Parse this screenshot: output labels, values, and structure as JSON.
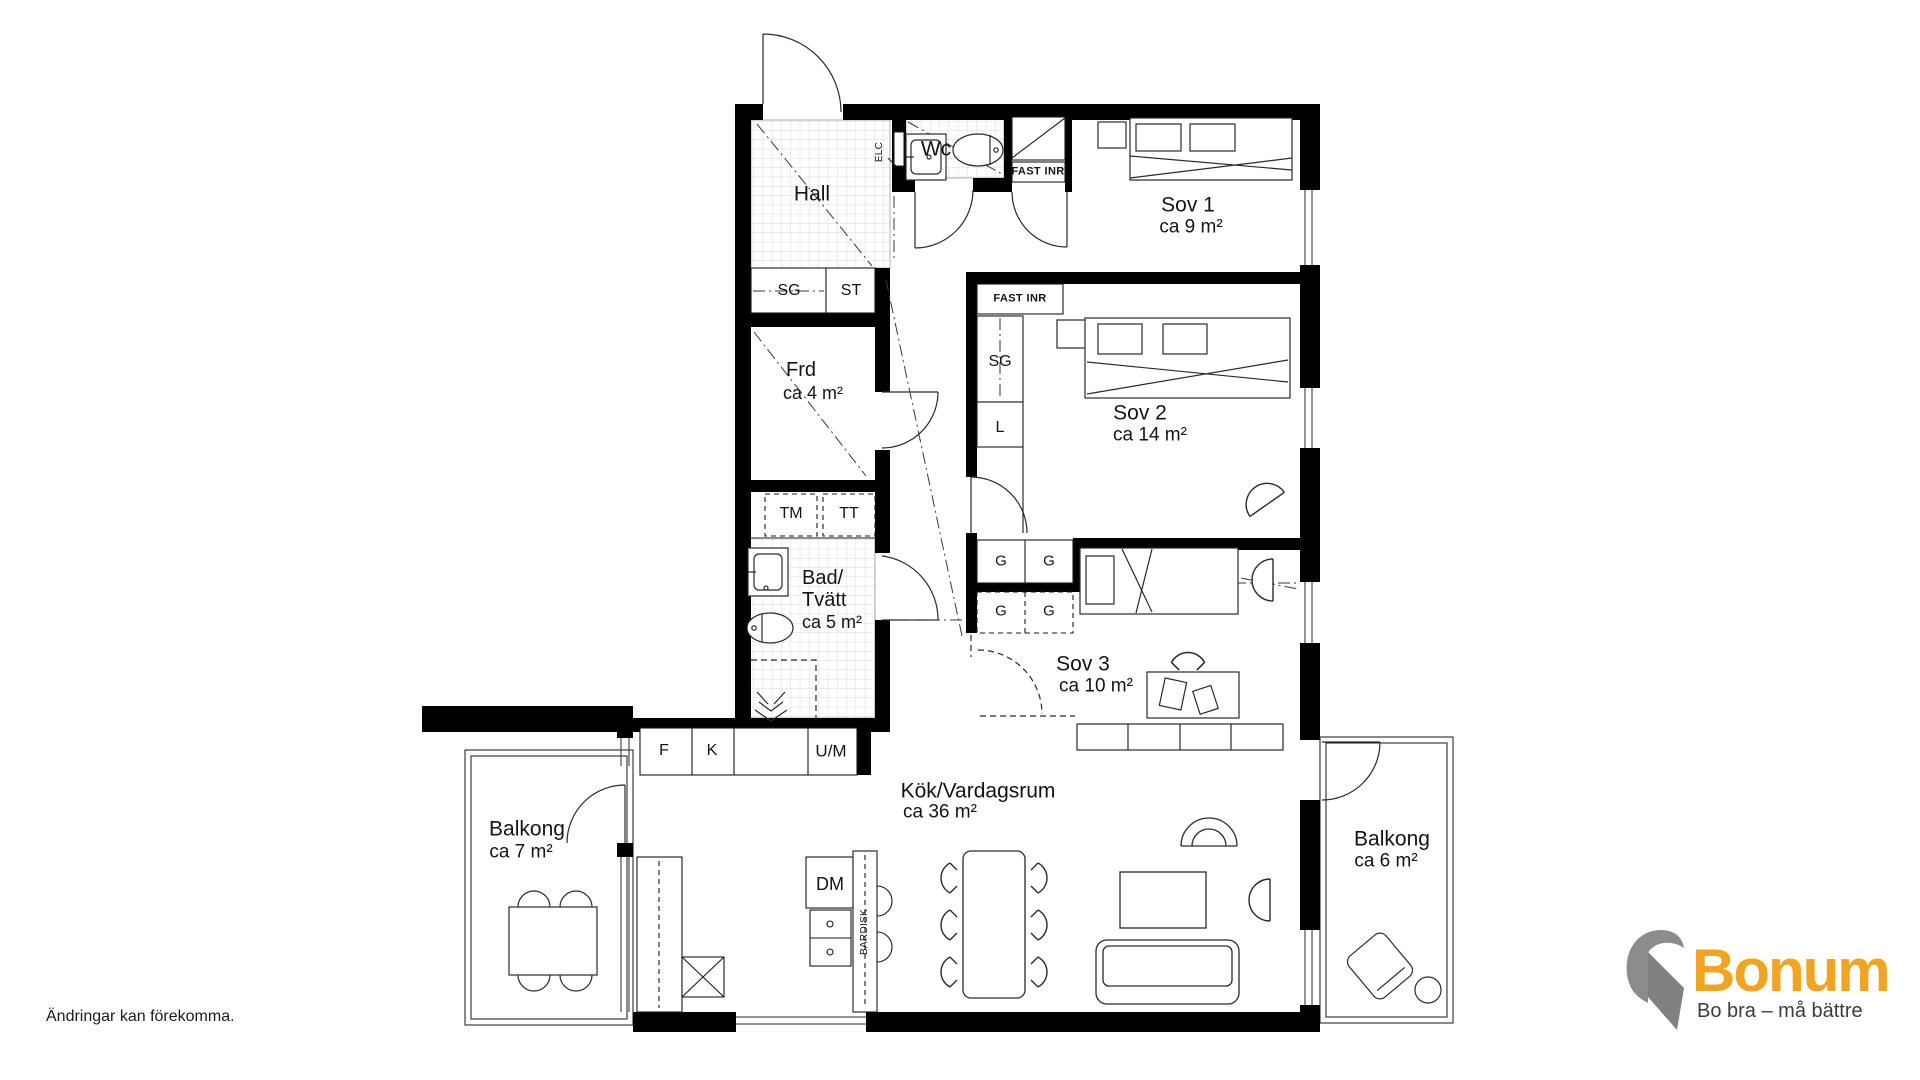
{
  "meta": {
    "disclaimer": "Ändringar kan förekomma."
  },
  "logo": {
    "brand": "Bonum",
    "tagline": "Bo bra – må bättre",
    "brand_color": "#F2A41E",
    "mark_color": "#8C8C8C"
  },
  "rooms": {
    "hall": {
      "name": "Hall"
    },
    "wc": {
      "name": "Wc"
    },
    "sov1": {
      "name": "Sov 1",
      "area": "ca 9 m²"
    },
    "sov2": {
      "name": "Sov 2",
      "area": "ca 14 m²"
    },
    "sov3": {
      "name": "Sov 3",
      "area": "ca 10 m²"
    },
    "frd": {
      "name": "Frd",
      "area": "ca 4 m²"
    },
    "bad": {
      "line1": "Bad/",
      "line2": "Tvätt",
      "area": "ca 5 m²"
    },
    "kok": {
      "name": "Kök/Vardagsrum",
      "area": "ca 36 m²"
    },
    "balkong_vanster": {
      "name": "Balkong",
      "area": "ca 7 m²"
    },
    "balkong_hoger": {
      "name": "Balkong",
      "area": "ca 6 m²"
    }
  },
  "closets": {
    "sg_hall": "SG",
    "st_hall": "ST",
    "fast_inr_ovre": "FAST INR",
    "fast_inr_nedre": "FAST INR",
    "sg_sov2": "SG",
    "l_sov2": "L",
    "g1": "G",
    "g2": "G",
    "g3": "G",
    "g4": "G"
  },
  "appliances": {
    "elc": "ELC",
    "tm": "TM",
    "tt": "TT",
    "f": "F",
    "k": "K",
    "um": "U/M",
    "dm": "DM",
    "bardisk": "BARDISK"
  }
}
